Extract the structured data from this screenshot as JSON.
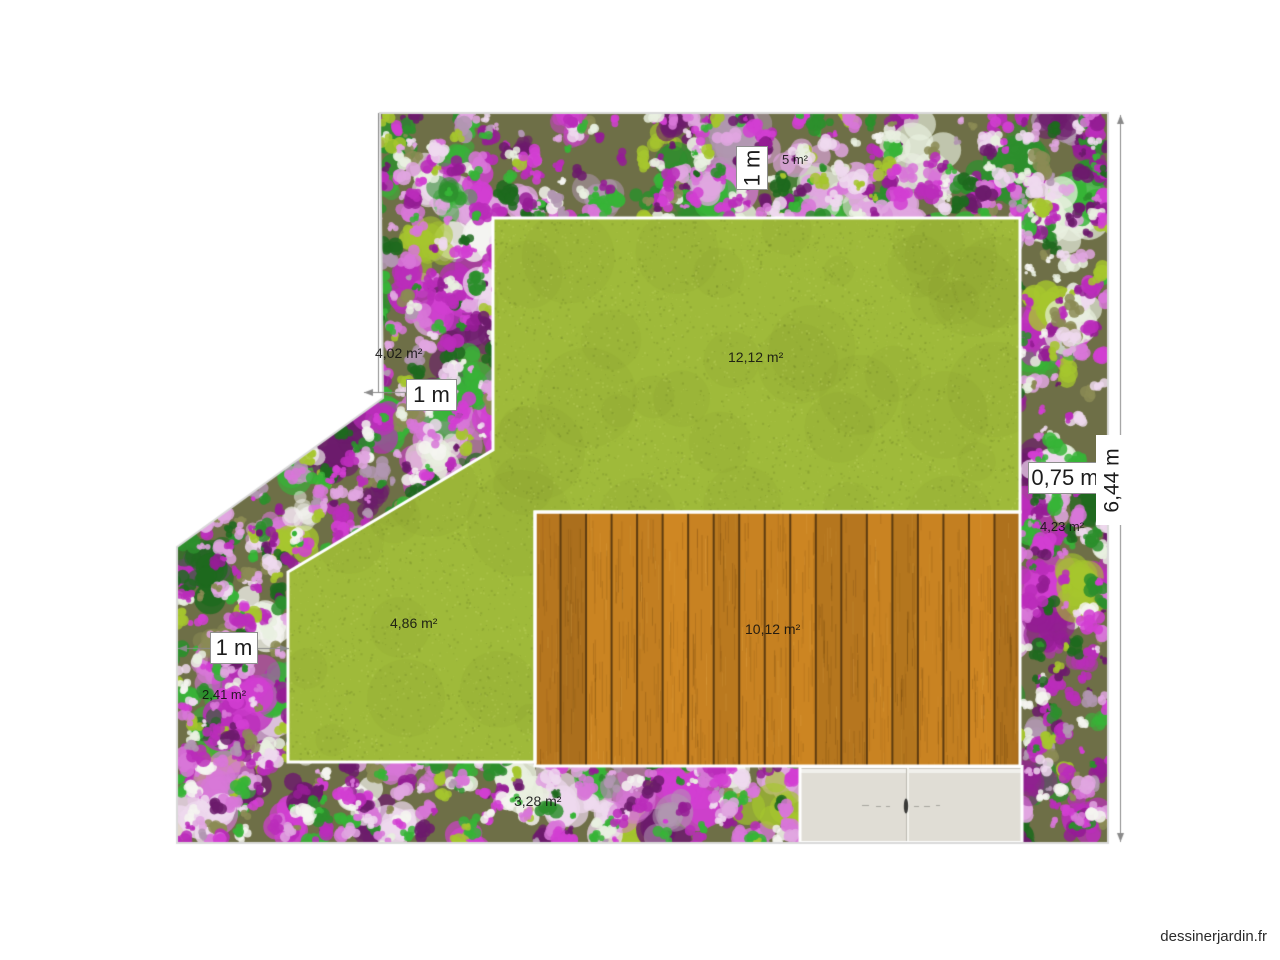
{
  "app": {
    "watermark": "dessinerjardin.fr"
  },
  "labels": {
    "top_bed_height": "1 m",
    "top_bed_area": "5 m²",
    "upper_left_bed_area": "4,02 m²",
    "upper_left_bed_width": "1 m",
    "main_lawn_area": "12,12 m²",
    "right_bed_width": "0,75 m",
    "garden_depth": "6,44 m",
    "right_bed_area": "4,23 m²",
    "left_bed_width": "1 m",
    "left_bed_area": "2,41 m²",
    "small_lawn_area": "4,86 m²",
    "deck_area": "10,12 m²",
    "bottom_bed_area": "3,28 m²"
  },
  "colors": {
    "lawn": "#9fba3a",
    "lawn_dark_speckle": "#5a6e1e",
    "lawn_light_speckle": "#d2e478",
    "deck_wood": "#bb7a20",
    "deck_gap": "#5e3c10",
    "bed_base": "#6e6f47",
    "terrace": "#e0ddd5",
    "terrace_edge": "#c6c4bb",
    "outline": "#d9d9d9",
    "separator": "#ffffff",
    "dimension": "#8a8a8a",
    "flower_palette": [
      "#bb2dbb",
      "#d23ed2",
      "#951d95",
      "#6c1b6c",
      "#d877d8",
      "#e0a6e0",
      "#eed9ee",
      "#e9f0e0",
      "#f4f4f0",
      "#37b437",
      "#2d8f2d",
      "#1e6a1e",
      "#a6c62e",
      "#8b8b55",
      "#b197b1"
    ]
  }
}
